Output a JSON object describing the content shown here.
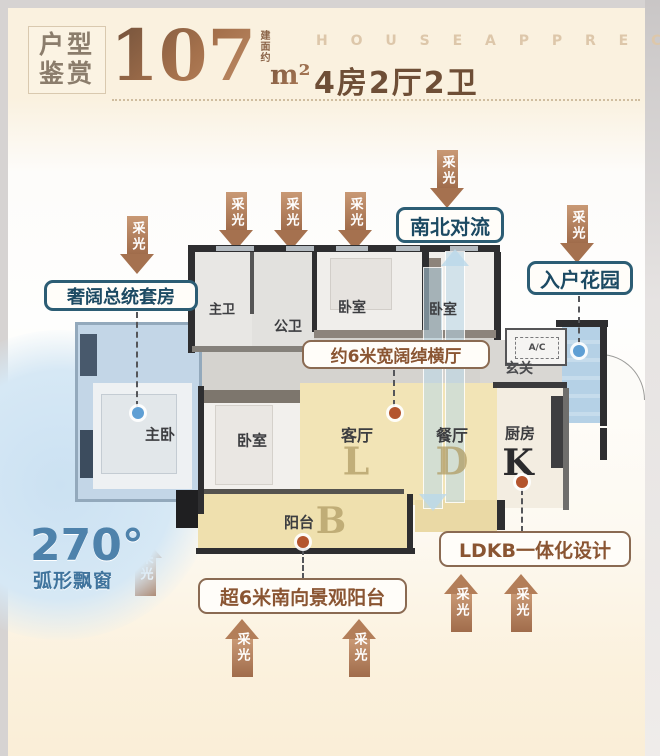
{
  "header": {
    "badge_line1": "户型",
    "badge_line2": "鉴赏",
    "area_prefix": "建面约",
    "area_value": "107",
    "area_unit": "m²",
    "subtitle_en": "H O U S E   A P P R E C I A T I O N",
    "subtitle_cn": "4房2厅2卫"
  },
  "labels": {
    "daylight": "采光"
  },
  "callouts": {
    "presidential_suite": "奢阔总统套房",
    "ns_convection": "南北对流",
    "entry_garden": "入户花园",
    "wide_hall": "约6米宽阔绰横厅",
    "ldkb": "LDKB一体化设计",
    "south_balcony": "超6米南向景观阳台",
    "bay_degree": "270°",
    "bay_label": "弧形飘窗"
  },
  "rooms": {
    "master_bedroom": "主卧",
    "master_bath": "主卫",
    "public_bath": "公卫",
    "bedroom": "卧室",
    "living": "客厅",
    "living_letter": "L",
    "dining": "餐厅",
    "dining_letter": "D",
    "kitchen": "厨房",
    "kitchen_letter": "K",
    "balcony": "阳台",
    "balcony_letter": "B",
    "foyer": "玄关",
    "ac_unit": "A/C"
  },
  "colors": {
    "bronze_arrow": "#b07a55",
    "blue_callout_border": "#2c5d74",
    "brown_callout_text": "#8a5532",
    "bay_blue_text": "#3f749e",
    "ldkb_yellow": "#f2e4b6",
    "suite_blue": "#c3d6e7",
    "garden_blue": "#b5d1e6"
  }
}
